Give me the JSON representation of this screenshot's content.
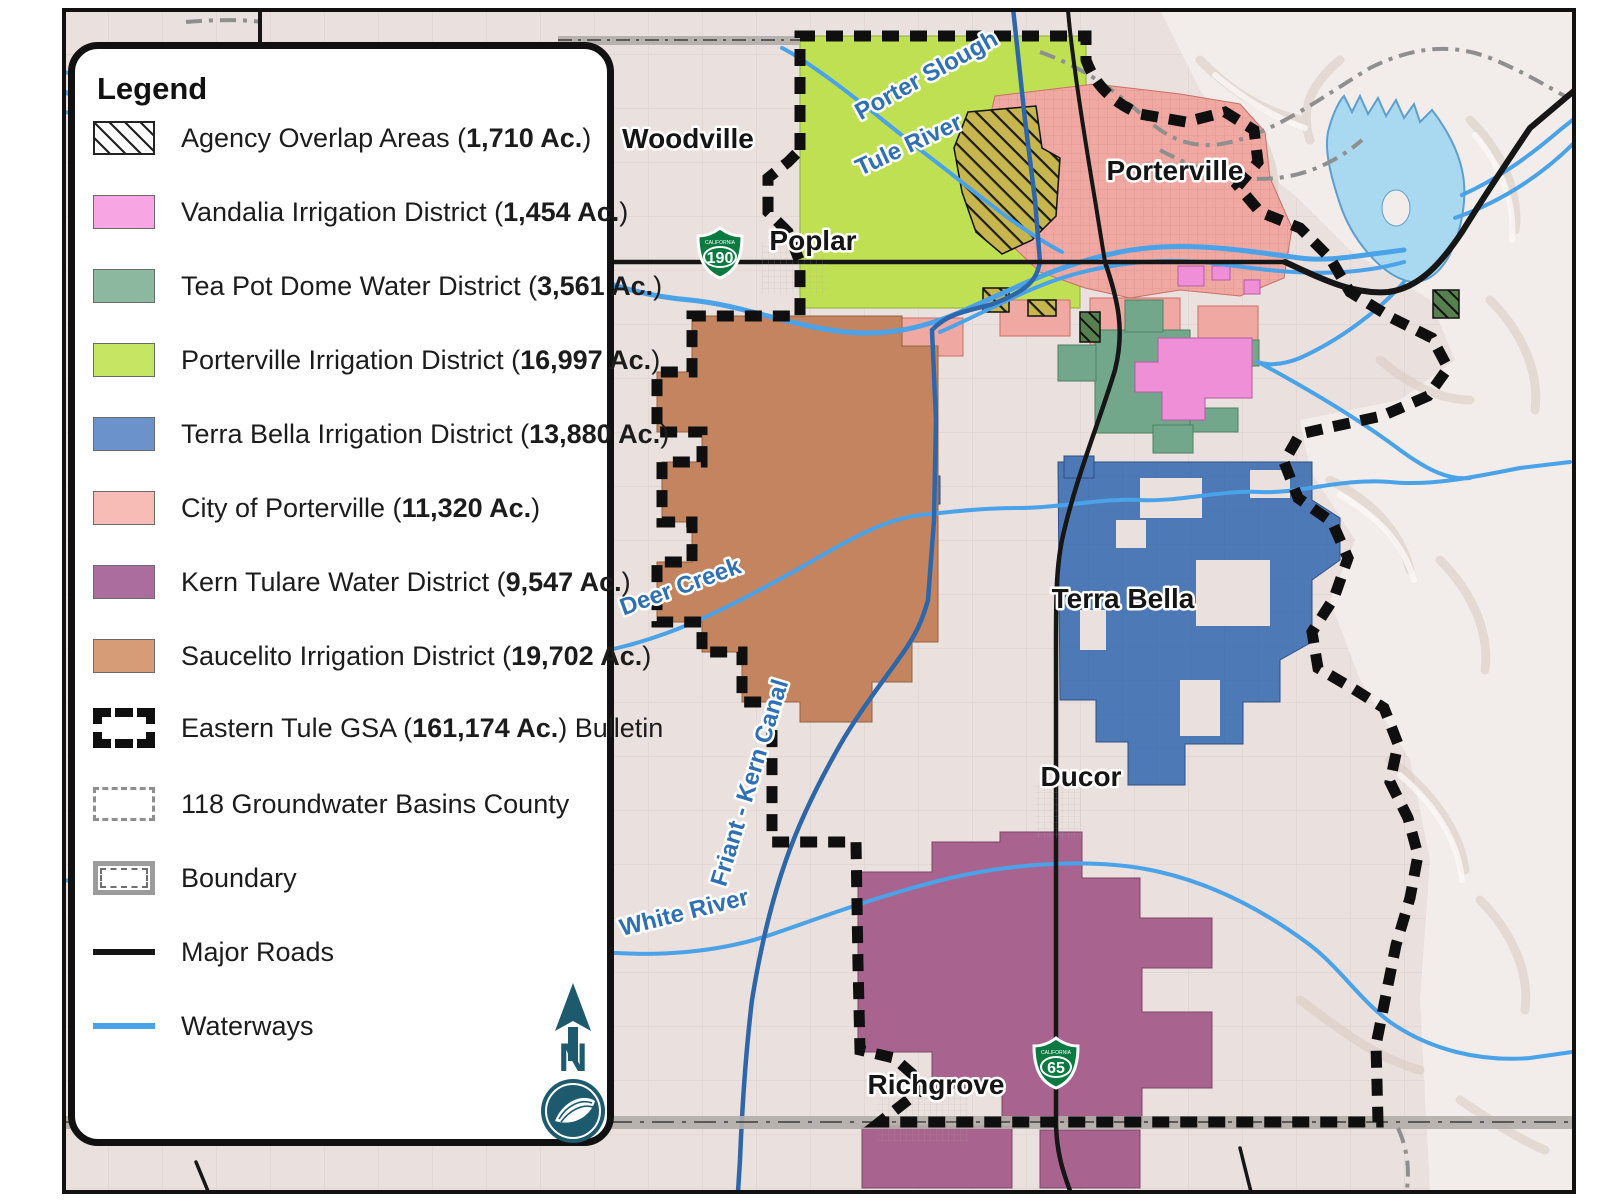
{
  "legend": {
    "title": "Legend",
    "north_letter": "N",
    "items": [
      {
        "pre": "Agency Overlap Areas (",
        "bold": "1,710 Ac.",
        "post": ")",
        "swatch": "hatch",
        "color": ""
      },
      {
        "pre": "Vandalia Irrigation District (",
        "bold": "1,454 Ac.",
        "post": ")",
        "swatch": "plain",
        "color": "#f8a5e4"
      },
      {
        "pre": "Tea Pot Dome Water District (",
        "bold": "3,561 Ac.",
        "post": ")",
        "swatch": "plain",
        "color": "#8cb8a0"
      },
      {
        "pre": "Porterville Irrigation District (",
        "bold": "16,997 Ac.",
        "post": ")",
        "swatch": "plain",
        "color": "#c6e562"
      },
      {
        "pre": "Terra Bella Irrigation District (",
        "bold": "13,880 Ac.",
        "post": ")",
        "swatch": "plain",
        "color": "#6b92cb"
      },
      {
        "pre": "City of Porterville (",
        "bold": "11,320 Ac.",
        "post": ")",
        "swatch": "plain",
        "color": "#f6bcb5"
      },
      {
        "pre": "Kern Tulare Water District (",
        "bold": "9,547 Ac.",
        "post": ")",
        "swatch": "plain",
        "color": "#aa6d9e"
      },
      {
        "pre": "Saucelito Irrigation District (",
        "bold": "19,702 Ac.",
        "post": ")",
        "swatch": "plain",
        "color": "#d59c77"
      },
      {
        "pre": "Eastern Tule GSA (",
        "bold": "161,174 Ac.",
        "post": ") Bulletin",
        "swatch": "gsa",
        "color": ""
      },
      {
        "pre": "118 Groundwater Basins County",
        "bold": "",
        "post": "",
        "swatch": "basin",
        "color": ""
      },
      {
        "pre": "Boundary",
        "bold": "",
        "post": "",
        "swatch": "county",
        "color": ""
      },
      {
        "pre": "Major Roads",
        "bold": "",
        "post": "",
        "swatch": "line",
        "color": "#141414"
      },
      {
        "pre": "Waterways",
        "bold": "",
        "post": "",
        "swatch": "line",
        "color": "#4aa2e8"
      }
    ]
  },
  "map": {
    "towns": [
      {
        "text": "Woodville"
      },
      {
        "text": "Poplar"
      },
      {
        "text": "Porterville"
      },
      {
        "text": "Terra Bella"
      },
      {
        "text": "Ducor"
      },
      {
        "text": "Richgrove"
      }
    ],
    "waterway_labels": [
      {
        "text": "Porter Slough"
      },
      {
        "text": "Tule River"
      },
      {
        "text": "Deer Creek"
      },
      {
        "text": "Friant - Kern Canal"
      },
      {
        "text": "White River"
      }
    ],
    "shields": [
      {
        "number": "190",
        "state": "CALIFORNIA"
      },
      {
        "number": "65",
        "state": "CALIFORNIA"
      }
    ],
    "colors": {
      "valley": "#eae0dd",
      "hills": "#f2edea",
      "hillshade": "#d9cbc1",
      "lake": "#a9d9f1",
      "lake_edge": "#5f9ecf",
      "river": "#4aa2e8",
      "canal": "#2d67a9",
      "road": "#161616",
      "county": "#b2adaa",
      "basin": "#8f8f8f",
      "gsa": "#0f0f0f",
      "porterville_id": "#bfe052",
      "city_porterville": "#efa9a2",
      "tea_pot": "#73a78b",
      "vandalia": "#ee8fd8",
      "terra_bella": "#4d7ab7",
      "saucelito": "#c3845f",
      "kern_tulare": "#a8648e",
      "overlap": "#c6b64d",
      "overlap_dark": "#57804f",
      "north_teal": "#1d5a6e"
    }
  }
}
